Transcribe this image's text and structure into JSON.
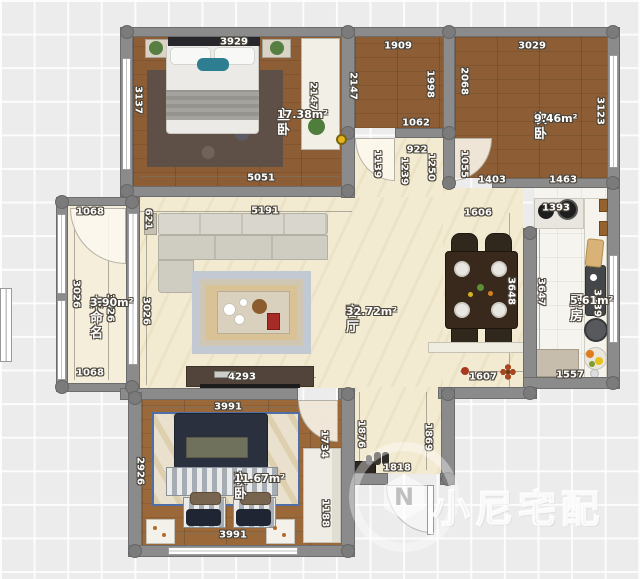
{
  "watermark": {
    "logo_letter": "N",
    "text": "小尼宅配"
  },
  "rooms": [
    {
      "name": "主卧",
      "area": "17.38m²",
      "x": 277,
      "y": 109
    },
    {
      "name": "次卧",
      "area": "9.46m²",
      "x": 534,
      "y": 113
    },
    {
      "name": "未命名",
      "area": "3.90m²",
      "x": 90,
      "y": 297
    },
    {
      "name": "客厅",
      "area": "32.72m²",
      "x": 346,
      "y": 306
    },
    {
      "name": "厨房",
      "area": "5.61m²",
      "x": 570,
      "y": 295
    },
    {
      "name": "次卧",
      "area": "11.67m²",
      "x": 234,
      "y": 473
    }
  ],
  "dimensions": [
    {
      "v": "3929",
      "x": 234,
      "y": 42,
      "o": "h"
    },
    {
      "v": "1909",
      "x": 398,
      "y": 46,
      "o": "h"
    },
    {
      "v": "3029",
      "x": 532,
      "y": 46,
      "o": "h"
    },
    {
      "v": "3137",
      "x": 138,
      "y": 100,
      "o": "v"
    },
    {
      "v": "2147",
      "x": 313,
      "y": 96,
      "o": "v"
    },
    {
      "v": "2147",
      "x": 353,
      "y": 86,
      "o": "v"
    },
    {
      "v": "1998",
      "x": 430,
      "y": 84,
      "o": "v"
    },
    {
      "v": "2068",
      "x": 464,
      "y": 81,
      "o": "v"
    },
    {
      "v": "3123",
      "x": 600,
      "y": 111,
      "o": "v"
    },
    {
      "v": "1062",
      "x": 416,
      "y": 123,
      "o": "h"
    },
    {
      "v": "922",
      "x": 417,
      "y": 150,
      "o": "h"
    },
    {
      "v": "1139",
      "x": 377,
      "y": 164,
      "o": "v"
    },
    {
      "v": "1239",
      "x": 404,
      "y": 171,
      "o": "v"
    },
    {
      "v": "1250",
      "x": 431,
      "y": 167,
      "o": "v"
    },
    {
      "v": "1055",
      "x": 464,
      "y": 164,
      "o": "v"
    },
    {
      "v": "1403",
      "x": 492,
      "y": 180,
      "o": "h"
    },
    {
      "v": "1463",
      "x": 563,
      "y": 180,
      "o": "h"
    },
    {
      "v": "5051",
      "x": 261,
      "y": 178,
      "o": "h"
    },
    {
      "v": "1393",
      "x": 556,
      "y": 208,
      "o": "h"
    },
    {
      "v": "1068",
      "x": 90,
      "y": 212,
      "o": "h"
    },
    {
      "v": "621",
      "x": 148,
      "y": 219,
      "o": "v"
    },
    {
      "v": "5191",
      "x": 265,
      "y": 211,
      "o": "h"
    },
    {
      "v": "1606",
      "x": 478,
      "y": 213,
      "o": "h"
    },
    {
      "v": "3026",
      "x": 76,
      "y": 294,
      "o": "v"
    },
    {
      "v": "3026",
      "x": 110,
      "y": 308,
      "o": "v"
    },
    {
      "v": "3026",
      "x": 146,
      "y": 311,
      "o": "v"
    },
    {
      "v": "3648",
      "x": 511,
      "y": 291,
      "o": "v"
    },
    {
      "v": "3647",
      "x": 541,
      "y": 292,
      "o": "v"
    },
    {
      "v": "3339",
      "x": 597,
      "y": 303,
      "o": "v"
    },
    {
      "v": "1068",
      "x": 90,
      "y": 373,
      "o": "h"
    },
    {
      "v": "4293",
      "x": 242,
      "y": 377,
      "o": "h"
    },
    {
      "v": "1607",
      "x": 483,
      "y": 377,
      "o": "h"
    },
    {
      "v": "1557",
      "x": 570,
      "y": 375,
      "o": "h"
    },
    {
      "v": "3991",
      "x": 228,
      "y": 407,
      "o": "h"
    },
    {
      "v": "1876",
      "x": 361,
      "y": 434,
      "o": "v"
    },
    {
      "v": "1869",
      "x": 428,
      "y": 437,
      "o": "v"
    },
    {
      "v": "1734",
      "x": 324,
      "y": 444,
      "o": "v"
    },
    {
      "v": "2926",
      "x": 140,
      "y": 471,
      "o": "v"
    },
    {
      "v": "1188",
      "x": 325,
      "y": 513,
      "o": "v"
    },
    {
      "v": "1818",
      "x": 397,
      "y": 468,
      "o": "h"
    },
    {
      "v": "3991",
      "x": 233,
      "y": 535,
      "o": "h"
    }
  ]
}
